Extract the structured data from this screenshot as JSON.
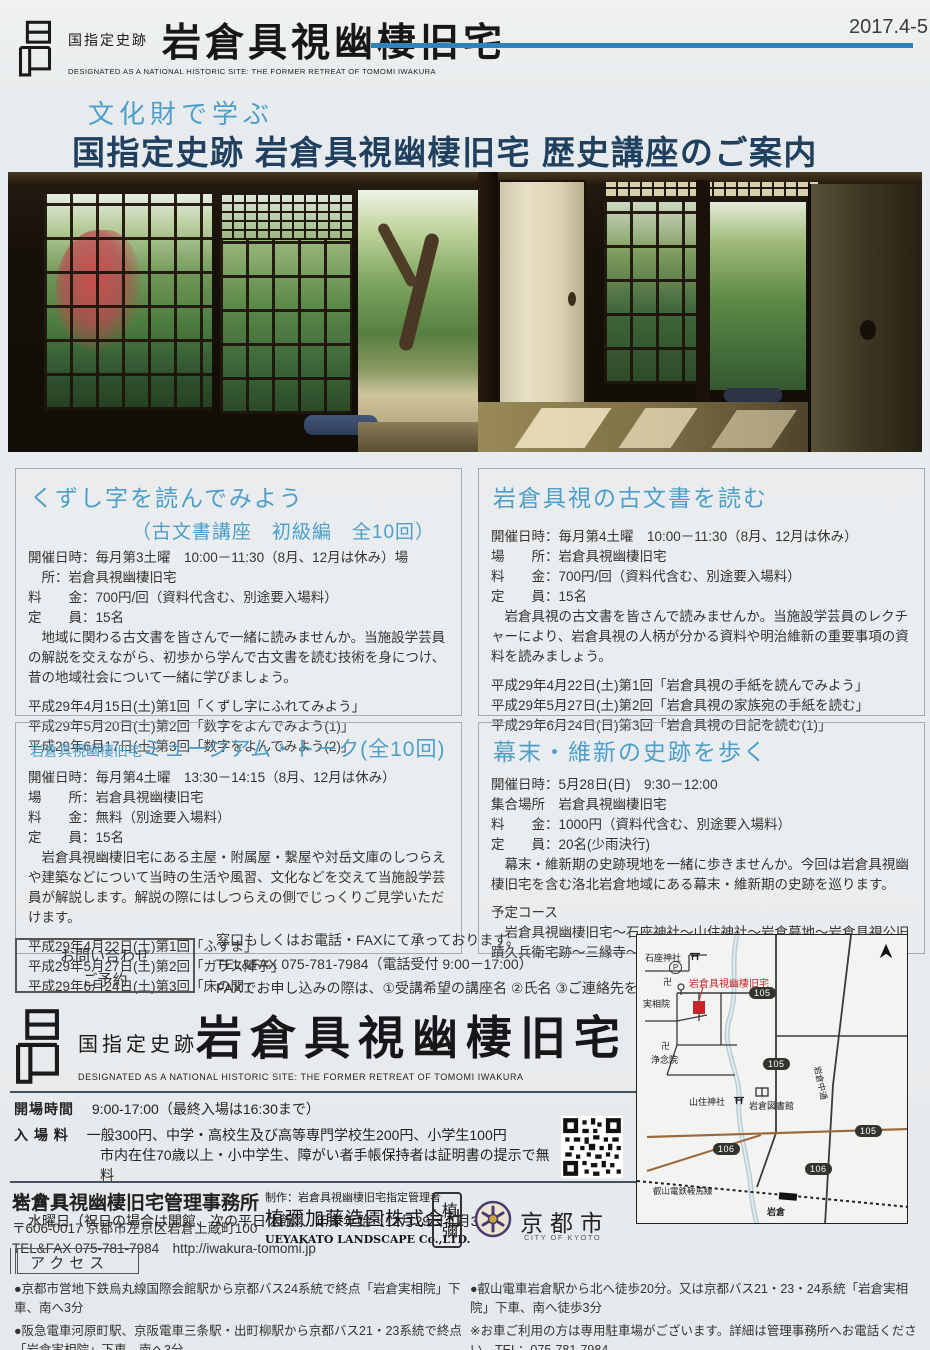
{
  "colors": {
    "accent_blue": "#2e82c0",
    "heading_blue": "#4d9fca",
    "title_navy": "#20405f",
    "marker_red": "#c3272b"
  },
  "header": {
    "site_label": "国指定史跡",
    "site_name": "岩倉具視幽棲旧宅",
    "site_name_en": "DESIGNATED AS A NATIONAL HISTORIC SITE: THE FORMER RETREAT OF TOMOMI IWAKURA",
    "issue": "2017.4-5"
  },
  "title": {
    "kicker": "文化財で学ぶ",
    "main": "国指定史跡 岩倉具視幽棲旧宅 歴史講座のご案内"
  },
  "courses": [
    {
      "title": "くずし字を読んでみよう",
      "subtitle": "（古文書講座　初級編　全10回）",
      "info_lines": [
        "開催日時：毎月第3土曜　10:00－11:30（8月、12月は休み）場",
        "　所：岩倉具視幽棲旧宅",
        "料　　金：700円/回（資料代含む、別途要入場料）",
        "定　　員：15名"
      ],
      "description": "　地域に関わる古文書を皆さんで一緒に読みませんか。当施設学芸員の解説を交えながら、初歩から学んで古文書を読む技術を身につけ、昔の地域社会について一緒に学びましょう。",
      "schedule": [
        "平成29年4月15日(土)第1回「くずし字にふれてみよう」",
        "平成29年5月20日(土)第2回「数字をよんでみよう(1)」",
        "平成29年6月17日(土)第3回「数字をよんでみよう(2)」"
      ]
    },
    {
      "title": "岩倉具視の古文書を読む",
      "info_lines": [
        "開催日時：毎月第4土曜　10:00－11:30（8月、12月は休み）",
        "場　　所：岩倉具視幽棲旧宅",
        "料　　金：700円/回（資料代含む、別途要入場料）",
        "定　　員：15名"
      ],
      "description": "　岩倉具視の古文書を皆さんで読みませんか。当施設学芸員のレクチャーにより、岩倉具視の人柄が分かる資料や明治維新の重要事項の資料を読みましょう。",
      "schedule": [
        "平成29年4月22日(土)第1回「岩倉具視の手紙を読んでみよう」",
        "平成29年5月27日(土)第2回「岩倉具視の家族宛の手紙を読む」",
        "平成29年6月24日(日)第3回「岩倉具視の日記を読む(1)」"
      ]
    },
    {
      "title_prefix": "岩倉具視幽棲旧宅",
      "title": "ミュージアム・トーク(全10回)",
      "info_lines": [
        "開催日時：毎月第4土曜　13:30－14:15（8月、12月は休み）",
        "場　　所：岩倉具視幽棲旧宅",
        "料　　金：無料（別途要入場料）",
        "定　　員：15名"
      ],
      "description": "　岩倉具視幽棲旧宅にある主屋・附属屋・繋屋や対岳文庫のしつらえや建築などについて当時の生活や風習、文化などを交えて当施設学芸員が解説します。解説の際にはしつらえの側でじっくりご見学いただけます。",
      "schedule": [
        "平成29年4月22日(土)第1回「ふすま」",
        "平成29年5月27日(土)第2回「ガラス障子」",
        "平成29年6月24日(土)第3回「床の間」"
      ]
    },
    {
      "title": "幕末・維新の史跡を歩く",
      "info_lines": [
        "開催日時：5月28日(日)　9:30－12:00",
        "集合場所　岩倉具視幽棲旧宅",
        "料　　金：1000円（資料代含む、別途要入場料）",
        "定　　員：20名(少雨決行)"
      ],
      "description": "　幕末・維新期の史跡現地を一緒に歩きませんか。今回は岩倉具視幽棲旧宅を含む洛北岩倉地域にある幕末・維新期の史跡を巡ります。",
      "course_heading": "予定コース",
      "course_route": "　岩倉具視幽棲旧宅～石座神社～山住神社～岩倉墓地～岩倉具視公旧蹟久兵衛宅跡～三縁寺～三宅八幡宮"
    }
  ],
  "contact": {
    "box_label_line1": "お問い合わせ",
    "box_label_line2": "ご予約",
    "line1": "窓口もしくはお電話・FAXにて承っております。",
    "line2": "TEL&FAX 075-781-7984（電話受付 9:00－17:00）",
    "line3": "FAXでお申し込みの際は、①受講希望の講座名 ②氏名 ③ご連絡先をご記入ください。"
  },
  "brand": {
    "site_label": "国指定史跡",
    "site_name": "岩倉具視幽棲旧宅",
    "site_name_en": "DESIGNATED AS A NATIONAL HISTORIC SITE: THE FORMER RETREAT OF TOMOMI IWAKURA"
  },
  "visitor_info": {
    "rows": [
      {
        "label": "開場時間",
        "value": "9:00-17:00（最終入場は16:30まで）"
      },
      {
        "label": "入 場 料",
        "value": "一般300円、中学・高校生及び高等専門学校生200円、小学生100円",
        "value2": "市内在住70歳以上・小中学生、障がい者手帳保持者は証明書の提示で無料"
      },
      {
        "label": "休 館 日",
        "value": "水曜日（祝日の場合は開館、次の平日休館）、年末年始（12月29日-1月3日）"
      }
    ]
  },
  "office": {
    "name": "岩倉具視幽棲旧宅管理事務所",
    "address": "〒606-0017 京都市左京区岩倉上蔵町100",
    "tel_url": "TEL&FAX 075-781-7984　http://iwakura-tomomi.jp"
  },
  "producer": {
    "credit": "制作：岩倉具視幽棲旧宅指定管理者",
    "company": "植彌加藤造園株式会社",
    "company_en": "UEYAKATO LANDSCAPE Co.,LTD.",
    "seal": "植彌",
    "city": "京都市",
    "city_en": "CITY OF KYOTO"
  },
  "access": {
    "label": "アクセス",
    "left_items": [
      "●京都市営地下鉄烏丸線国際会館駅から京都バス24系統で終点「岩倉実相院」下車、南へ3分",
      "●阪急電車河原町駅、京阪電車三条駅・出町柳駅から京都バス21・23系統で終点「岩倉実相院」下車、南へ3分"
    ],
    "right_items": [
      "●叡山電車岩倉駅から北へ徒歩20分。又は京都バス21・23・24系統「岩倉実相院」下車、南へ徒歩3分",
      "※お車ご利用の方は専用駐車場がございます。詳細は管理事務所へお電話ください。TEL：075-781-7984"
    ]
  },
  "map": {
    "labels": {
      "ishikura_shrine": "石座神社",
      "parking": "P",
      "site": "岩倉具視幽棲旧宅",
      "manji": "卍",
      "jissoin": "実相院",
      "jonenin": "浄念院",
      "yamazumi_shrine": "山住神社",
      "library": "岩倉図書館",
      "nakadori": "岩倉中通",
      "railway": "叡山電鉄鞍馬線",
      "station": "岩倉",
      "route_105": "105",
      "route_106": "106"
    }
  }
}
